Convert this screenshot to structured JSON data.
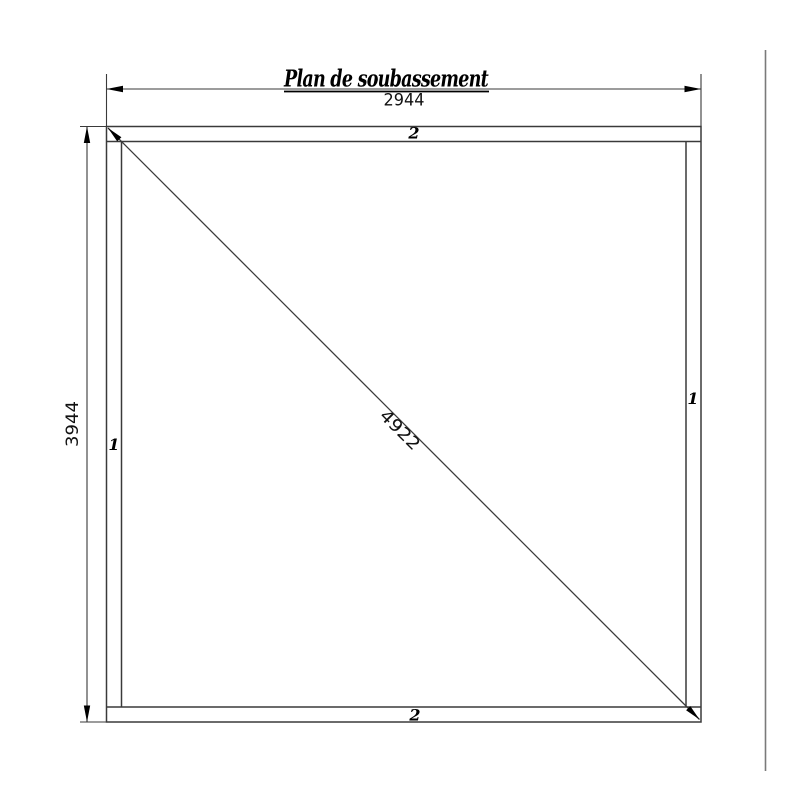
{
  "page": {
    "background": "#ffffff",
    "line_color": "#3a3a3a",
    "sheet_border_color": "#7a7a7a",
    "text_color": "#000000"
  },
  "drawing": {
    "title": "Plan de soubassement",
    "dimensions": {
      "width": "2944",
      "height": "3944",
      "diagonal": "4922"
    },
    "part_labels": {
      "top_rail": "2",
      "bottom_rail": "2",
      "left_stile": "1",
      "right_stile": "1"
    }
  }
}
